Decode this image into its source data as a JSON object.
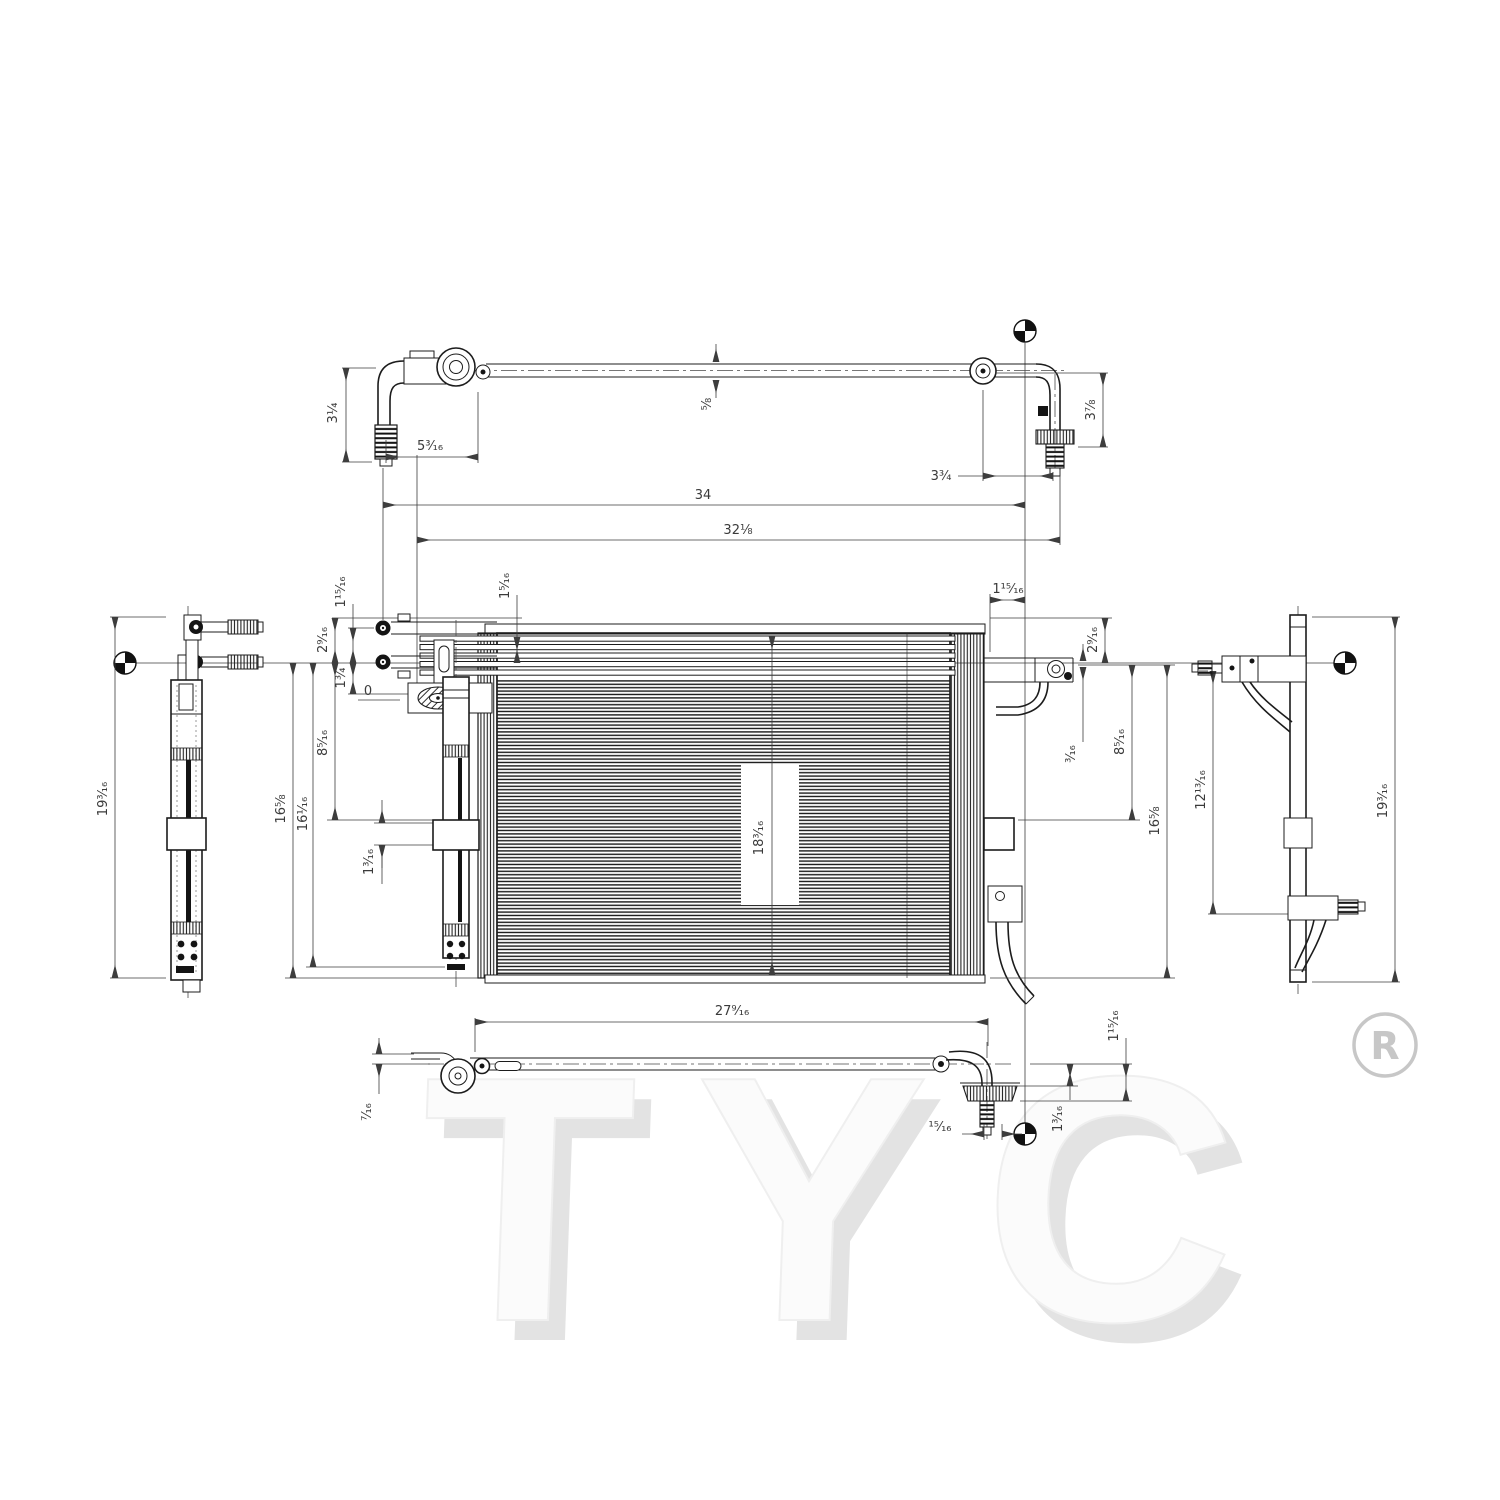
{
  "brand": {
    "name": "TYC",
    "registered": "R"
  },
  "dims": {
    "top_left_height": "3¼",
    "top_left_run": "5³⁄₁₆",
    "tube_od": "⅝",
    "top_right_height": "3⅞",
    "top_right_run": "3¾",
    "overall_width": "34",
    "secondary_width": "32⅛",
    "left_stud_to_center": "1¹⁵⁄₁₆",
    "left_top_to_center": "2⁹⁄₁₆",
    "left_center_to_zero": "1¾",
    "zero_ref": "0",
    "left_center_to_mount": "8⁵⁄₁₆",
    "left_center_to_bottom": "16⅝",
    "left_center_to_core_bottom": "16¹⁄₁₆",
    "left_mount_height": "1³⁄₁₆",
    "core_top_to_center": "1⁵⁄₁₆",
    "left_overall_height": "19³⁄₁₆",
    "right_stud_to_datum": "1¹⁵⁄₁₆",
    "right_top_to_center": "2⁹⁄₁₆",
    "right_center_offset": "³⁄₁₆",
    "right_center_to_mount": "8⁵⁄₁₆",
    "right_center_to_bottom": "16⅝",
    "right_bracket_span": "12¹³⁄₁₆",
    "right_overall_height": "19³⁄₁₆",
    "core_height": "18³⁄₁₆",
    "core_width": "27⁹⁄₁₆",
    "bottom_bracket_offset": "⁷⁄₁₆",
    "bottom_right_height": "1¹⁵⁄₁₆",
    "bottom_hose_drop": "1³⁄₁₆",
    "bottom_valve_offset": "¹⁵⁄₁₆"
  }
}
